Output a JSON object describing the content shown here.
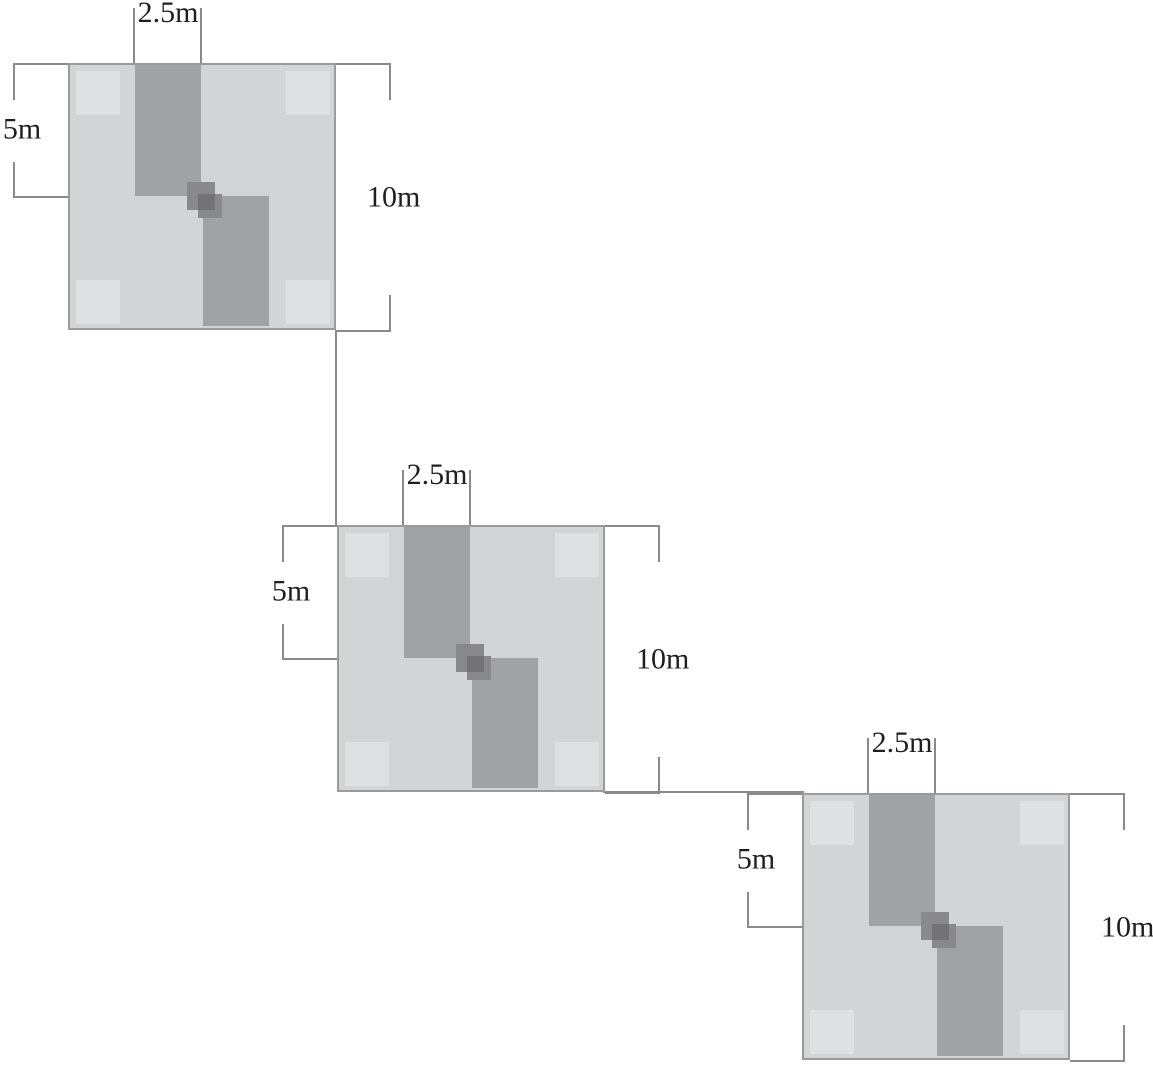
{
  "figure": {
    "colors": {
      "background": "#ffffff",
      "plot_fill": "#d3d4d6",
      "strip_fill": "#a1a2a4",
      "corner_fill": "#dfe0e2",
      "center_fill": "#89898b",
      "center_overlap_fill": "#737375",
      "line": "#8a8a8a",
      "border": "#9b9b9d",
      "text": "#1f1f1f"
    },
    "plots": [
      {
        "labels": {
          "strip_width": "2.5m",
          "half_side": "5m",
          "side": "10m"
        }
      },
      {
        "labels": {
          "strip_width": "2.5m",
          "half_side": "5m",
          "side": "10m"
        }
      },
      {
        "labels": {
          "strip_width": "2.5m",
          "half_side": "5m",
          "side": "10m"
        }
      }
    ]
  }
}
